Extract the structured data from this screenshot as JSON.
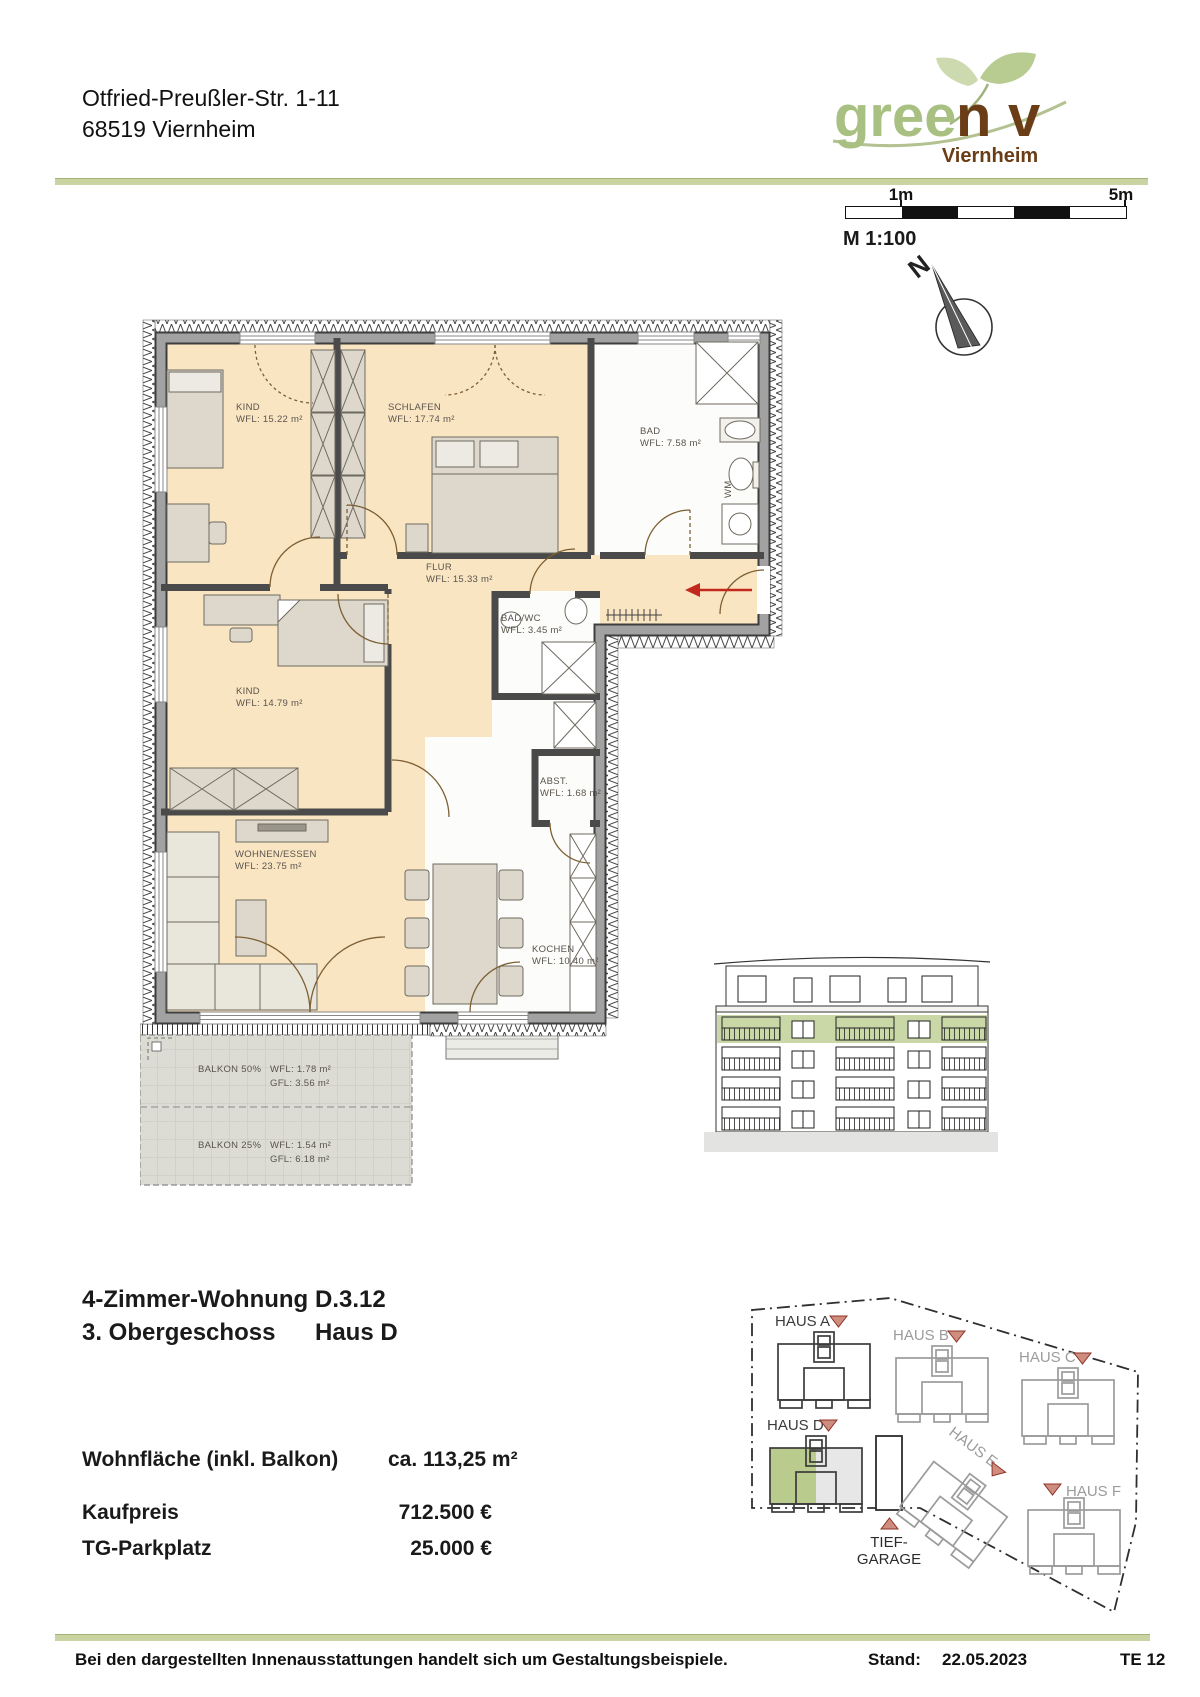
{
  "header": {
    "address_line1": "Otfried-Preußler-Str. 1-11",
    "address_line2": "68519 Viernheim"
  },
  "logo": {
    "part_green": "gree",
    "part_brown_n": "n",
    "part_brown_v": "v",
    "subtitle": "Viernheim"
  },
  "scalebar": {
    "label_left": "1m",
    "label_right": "5m",
    "scale_text": "M 1:100"
  },
  "compass": {
    "north_label": "N"
  },
  "floorplan": {
    "rooms": [
      {
        "name": "KIND",
        "area": "WFL: 15.22 m²"
      },
      {
        "name": "SCHLAFEN",
        "area": "WFL: 17.74 m²"
      },
      {
        "name": "BAD",
        "area": "WFL: 7.58 m²"
      },
      {
        "name": "FLUR",
        "area": "WFL: 15.33 m²"
      },
      {
        "name": "BAD/WC",
        "area": "WFL: 3.45 m²"
      },
      {
        "name": "KIND",
        "area": "WFL: 14.79 m²"
      },
      {
        "name": "ABST.",
        "area": "WFL: 1.68 m²"
      },
      {
        "name": "WOHNEN/ESSEN",
        "area": "WFL: 23.75 m²"
      },
      {
        "name": "KOCHEN",
        "area": "WFL: 10.40 m²"
      }
    ],
    "balconies": [
      {
        "name": "BALKON 50%",
        "wfl": "WFL: 1.78 m²",
        "gfl": "GFL: 3.56 m²"
      },
      {
        "name": "BALKON 25%",
        "wfl": "WFL: 1.54 m²",
        "gfl": "GFL: 6.18 m²"
      }
    ],
    "washer_label": "WM"
  },
  "unit": {
    "type_label": "4-Zimmer-Wohnung",
    "type_value": "D.3.12",
    "floor_label": "3. Obergeschoss",
    "floor_value": "Haus D"
  },
  "pricing": {
    "area_label": "Wohnfläche (inkl. Balkon)",
    "area_value": "ca. 113,25 m²",
    "price_label": "Kaufpreis",
    "price_value": "712.500 €",
    "parking_label": "TG-Parkplatz",
    "parking_value": "25.000 €"
  },
  "siteplan": {
    "houses": [
      "HAUS A",
      "HAUS B",
      "HAUS C",
      "HAUS D",
      "HAUS E",
      "HAUS F"
    ],
    "garage_line1": "TIEF-",
    "garage_line2": "GARAGE"
  },
  "footer": {
    "disclaimer": "Bei den dargestellten Innenausstattungen handelt sich um Gestaltungsbeispiele.",
    "stand_label": "Stand:",
    "stand_date": "22.05.2023",
    "sheet": "TE 12"
  }
}
